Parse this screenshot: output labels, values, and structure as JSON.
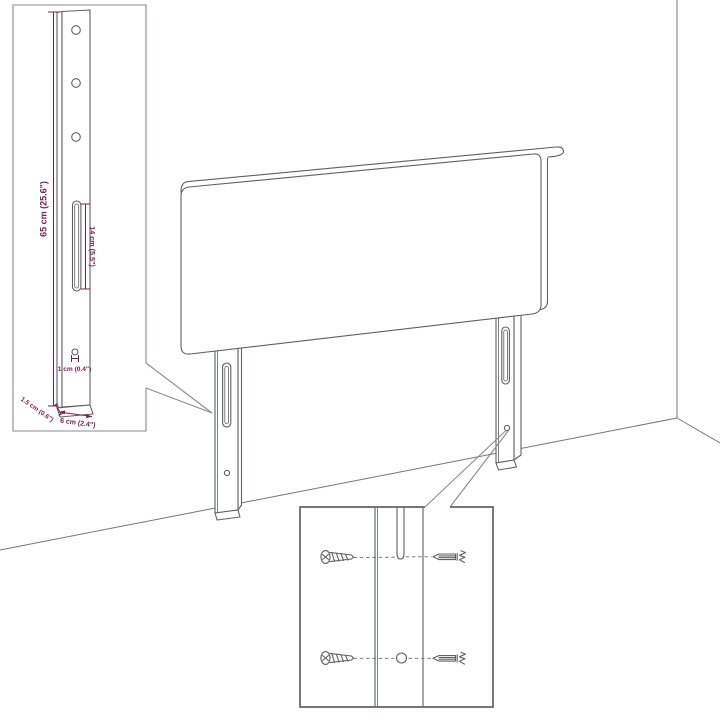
{
  "diagram": {
    "type": "headboard-assembly-dimension-diagram",
    "labels": {
      "bracket_height": "65 cm (25.6\")",
      "slot_length": "14 cm (5.5\")",
      "hole_diameter": "1 cm (0.4\")",
      "bracket_thickness": "1.5 cm (0.6\")",
      "bracket_width": "6 cm (2.4\")"
    },
    "colors": {
      "dimension_accent": "#7a2150",
      "line_art": "#5f6062",
      "background": "#ffffff"
    }
  }
}
